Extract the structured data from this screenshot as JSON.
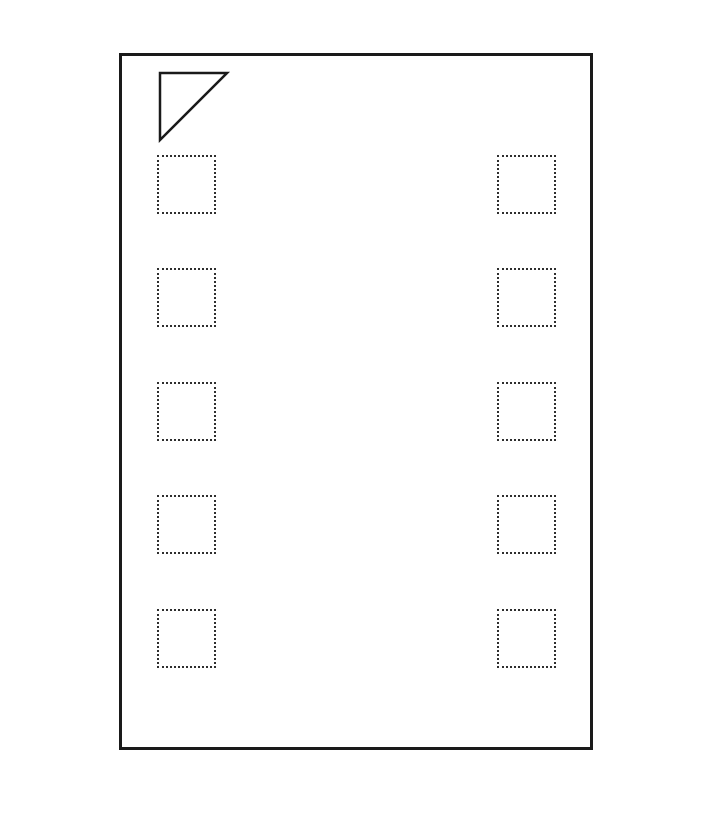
{
  "page": {
    "background_color": "#ffffff"
  },
  "package_outline": {
    "shape": "rectangle",
    "border_color": "#1a1a1a",
    "border_width": 3,
    "x": 119,
    "y": 53,
    "width": 474,
    "height": 697,
    "pin1_marker": {
      "shape": "right-triangle-outline",
      "points": "38,17 105,17 38,84",
      "stroke_color": "#1a1a1a",
      "stroke_width": 2.5,
      "fill": "none"
    },
    "pads": {
      "count": 10,
      "columns": 2,
      "rows": 5,
      "size": 59,
      "border_style": "dotted",
      "border_color": "#2e2e2e",
      "positions": [
        {
          "name": "pad-left-1",
          "x": 38,
          "y": 102
        },
        {
          "name": "pad-left-2",
          "x": 38,
          "y": 215
        },
        {
          "name": "pad-left-3",
          "x": 38,
          "y": 329
        },
        {
          "name": "pad-left-4",
          "x": 38,
          "y": 442
        },
        {
          "name": "pad-left-5",
          "x": 38,
          "y": 556
        },
        {
          "name": "pad-right-1",
          "x": 378,
          "y": 102
        },
        {
          "name": "pad-right-2",
          "x": 378,
          "y": 215
        },
        {
          "name": "pad-right-3",
          "x": 378,
          "y": 329
        },
        {
          "name": "pad-right-4",
          "x": 378,
          "y": 442
        },
        {
          "name": "pad-right-5",
          "x": 378,
          "y": 556
        }
      ]
    }
  }
}
